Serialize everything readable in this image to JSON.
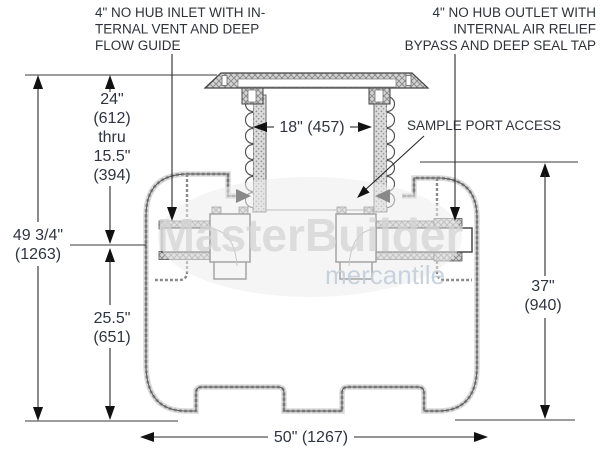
{
  "diagram": {
    "watermark": {
      "name": "MasterBuilder",
      "subname": "mercantile"
    },
    "callouts": {
      "inlet": {
        "lines": [
          "4\" NO HUB INLET WITH IN-",
          "TERNAL VENT AND DEEP",
          "FLOW GUIDE"
        ]
      },
      "outlet": {
        "lines": [
          "4\" NO HUB OUTLET WITH",
          "INTERNAL AIR RELIEF",
          "BYPASS AND DEEP SEAL TAP"
        ]
      },
      "sample_port": {
        "label": "SAMPLE PORT ACCESS"
      }
    },
    "dimensions": {
      "riser_opening_width": {
        "label": "18\" (457)"
      },
      "overall_height": {
        "lines": [
          "49 3/4\"",
          "(1263)"
        ]
      },
      "cover_depth_range": {
        "lines": [
          "24\"",
          "(612)",
          "thru",
          "15.5\"",
          "(394)"
        ]
      },
      "outlet_to_base": {
        "lines": [
          "25.5\"",
          "(651)"
        ]
      },
      "tank_height": {
        "lines": [
          "37\"",
          "(940)"
        ]
      },
      "overall_length": {
        "label": "50\" (1267)"
      }
    }
  }
}
